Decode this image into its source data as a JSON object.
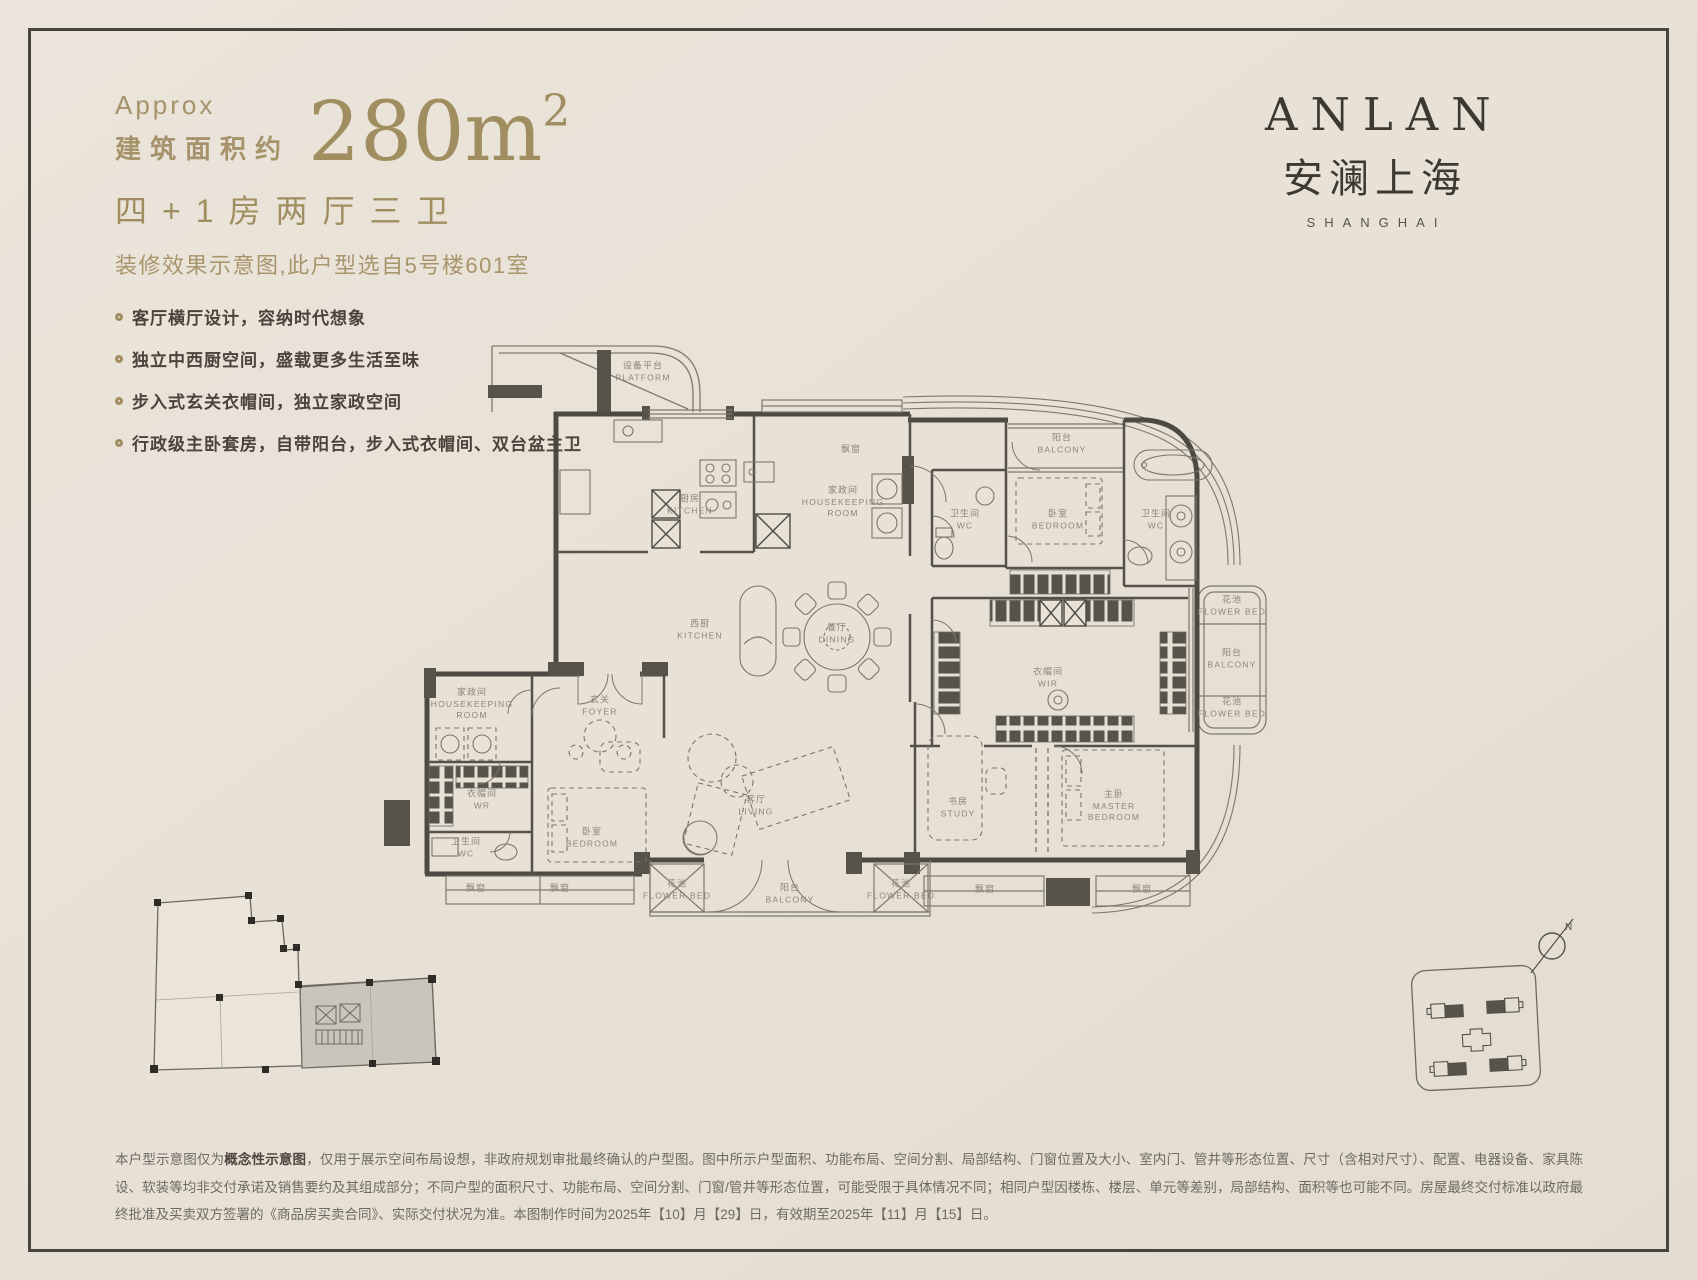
{
  "page": {
    "bg": "#e7e1d6",
    "accent": "#a18e60",
    "ink": "#47413a",
    "frame": "#49443d",
    "wall": "#4e4a43",
    "line": "#7e786d"
  },
  "header": {
    "approx": "Approx",
    "area_label": "建筑面积约",
    "area_value": "280m",
    "area_superscript": "2",
    "rooms_title": "四+1房两厅三卫",
    "subtitle": "装修效果示意图,此户型选自5号楼601室",
    "features": [
      "客厅横厅设计，容纳时代想象",
      "独立中西厨空间，盛载更多生活至味",
      "步入式玄关衣帽间，独立家政空间",
      "行政级主卧套房，自带阳台，步入式衣帽间、双台盆主卫"
    ]
  },
  "brand": {
    "en": "ANLAN",
    "cn": "安澜上海",
    "sub": "SHANGHAI"
  },
  "compass": {
    "north": "N"
  },
  "floorplan": {
    "rooms": [
      {
        "id": "platform",
        "cn": "设备平台",
        "en": "PLATFORM",
        "x": 643,
        "y": 372
      },
      {
        "id": "kitchen",
        "cn": "厨房",
        "en": "KITCHEN",
        "x": 690,
        "y": 505
      },
      {
        "id": "housekeeping-room-north",
        "cn": "家政间",
        "en": "HOUSEKEEPING ROOM",
        "x": 843,
        "y": 502
      },
      {
        "id": "bay-window-north",
        "cn": "飘窗",
        "en": "",
        "x": 851,
        "y": 450
      },
      {
        "id": "wc-north",
        "cn": "卫生间",
        "en": "WC",
        "x": 965,
        "y": 520
      },
      {
        "id": "balcony-northeast",
        "cn": "阳台",
        "en": "BALCONY",
        "x": 1062,
        "y": 444
      },
      {
        "id": "bedroom-northeast",
        "cn": "卧室",
        "en": "BEDROOM",
        "x": 1058,
        "y": 520
      },
      {
        "id": "wc-master",
        "cn": "卫生间",
        "en": "WC",
        "x": 1156,
        "y": 520
      },
      {
        "id": "west-kitchen",
        "cn": "西厨",
        "en": "KITCHEN",
        "x": 700,
        "y": 630
      },
      {
        "id": "dining",
        "cn": "餐厅",
        "en": "DINING",
        "x": 837,
        "y": 634
      },
      {
        "id": "foyer",
        "cn": "玄关",
        "en": "FOYER",
        "x": 600,
        "y": 706
      },
      {
        "id": "housekeeping-room-west",
        "cn": "家政间",
        "en": "HOUSEKEEPING ROOM",
        "x": 472,
        "y": 704
      },
      {
        "id": "walk-in-robe-west",
        "cn": "衣帽间",
        "en": "WR",
        "x": 482,
        "y": 800
      },
      {
        "id": "wc-west",
        "cn": "卫生间",
        "en": "WC",
        "x": 466,
        "y": 848
      },
      {
        "id": "bedroom-southwest",
        "cn": "卧室",
        "en": "BEDROOM",
        "x": 592,
        "y": 838
      },
      {
        "id": "living",
        "cn": "客厅",
        "en": "LIVING",
        "x": 756,
        "y": 806
      },
      {
        "id": "study",
        "cn": "书房",
        "en": "STUDY",
        "x": 958,
        "y": 808
      },
      {
        "id": "walk-in-robe-master",
        "cn": "衣帽间",
        "en": "WIR",
        "x": 1048,
        "y": 678
      },
      {
        "id": "master-bedroom",
        "cn": "主卧",
        "en": "MASTER BEDROOM",
        "x": 1114,
        "y": 806
      },
      {
        "id": "balcony-south",
        "cn": "阳台",
        "en": "BALCONY",
        "x": 790,
        "y": 894
      },
      {
        "id": "flower-bed-south-left",
        "cn": "花池",
        "en": "FLOWER BED",
        "x": 677,
        "y": 890
      },
      {
        "id": "flower-bed-south-right",
        "cn": "花池",
        "en": "FLOWER BED",
        "x": 901,
        "y": 890
      },
      {
        "id": "flower-bed-east-upper",
        "cn": "花池",
        "en": "FLOWER BED",
        "x": 1232,
        "y": 606
      },
      {
        "id": "balcony-east",
        "cn": "阳台",
        "en": "BALCONY",
        "x": 1232,
        "y": 659
      },
      {
        "id": "flower-bed-east-lower",
        "cn": "花池",
        "en": "FLOWER BED",
        "x": 1232,
        "y": 708
      },
      {
        "id": "bay-window-sw1",
        "cn": "飘窗",
        "en": "",
        "x": 476,
        "y": 889
      },
      {
        "id": "bay-window-sw2",
        "cn": "飘窗",
        "en": "",
        "x": 560,
        "y": 889
      },
      {
        "id": "bay-window-se1",
        "cn": "飘窗",
        "en": "",
        "x": 985,
        "y": 890
      },
      {
        "id": "bay-window-se2",
        "cn": "飘窗",
        "en": "",
        "x": 1142,
        "y": 890
      }
    ]
  },
  "disclaimer": {
    "lead": "本户型示意图仅为",
    "bold": "概念性示意图",
    "body": "，仅用于展示空间布局设想，非政府规划审批最终确认的户型图。图中所示户型面积、功能布局、空间分割、局部结构、门窗位置及大小、室内门、管井等形态位置、尺寸（含相对尺寸）、配置、电器设备、家具陈设、软装等均非交付承诺及销售要约及其组成部分；不同户型的面积尺寸、功能布局、空间分割、门窗/管井等形态位置，可能受限于具体情况不同；相同户型因楼栋、楼层、单元等差别，局部结构、面积等也可能不同。房屋最终交付标准以政府最终批准及买卖双方签署的《商品房买卖合同》、实际交付状况为准。本图制作时间为2025年【10】月【29】日，有效期至2025年【11】月【15】日。"
  }
}
